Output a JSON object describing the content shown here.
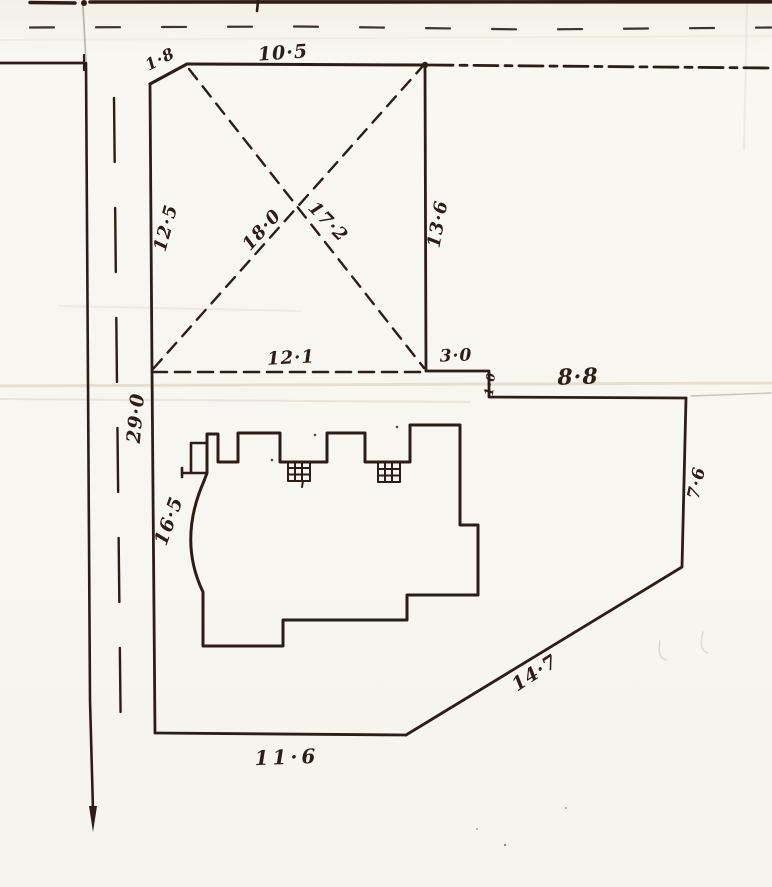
{
  "plan": {
    "dimensions": {
      "top_left_side": "1·8",
      "top_side": "10·5",
      "left_upper_side": "12·5",
      "diagonal_a": "18·0",
      "diagonal_b": "17·2",
      "right_upper_side": "13·6",
      "middle_side": "12·1",
      "step_right": "3·0",
      "step_down": "1·0",
      "top_right_side": "8·8",
      "right_lower_side": "7·6",
      "left_total": "29·0",
      "left_lower_side": "16·5",
      "lower_right_diagonal_side": "14·7",
      "bottom_side": "11·6"
    }
  },
  "colors": {
    "ink": "#2e1d16",
    "paper": "#f8f6f0",
    "crease": "#d9cbb8",
    "faint": "#b9ab99"
  }
}
